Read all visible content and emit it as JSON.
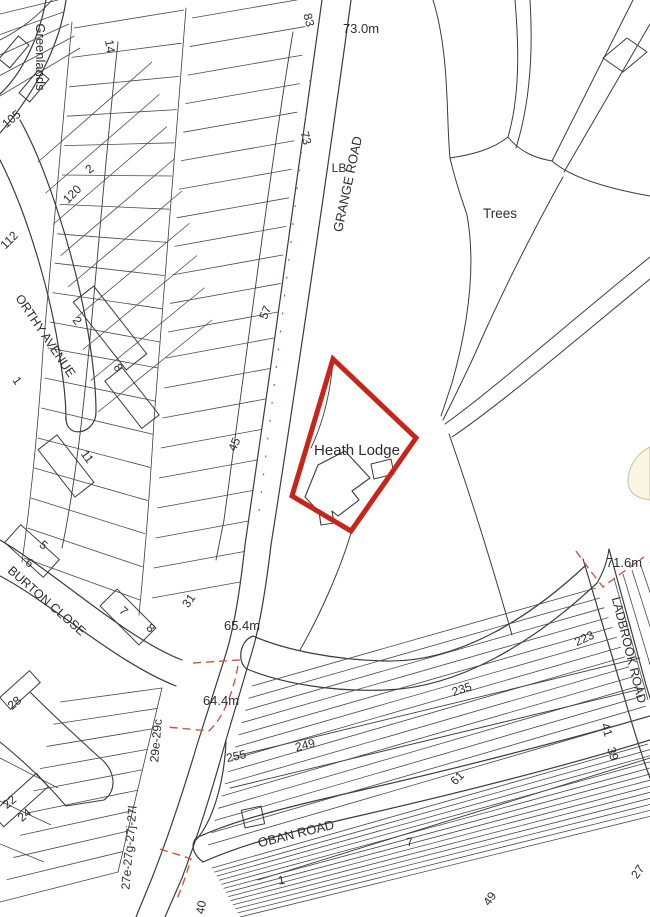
{
  "map": {
    "title": "Ordnance-survey style location plan, Heath Lodge, Grange Road",
    "colors": {
      "background": "#ffffff",
      "linework": "#3c3c3c",
      "plot_line": "#4a4a4a",
      "site_red": "#c8251a",
      "dashed_red": "#cf5742",
      "tan_fill": "#faf6e3",
      "tan_stroke": "#c9c09b"
    },
    "site_boundary": {
      "points": "333,359 416,438 351,531 292,496",
      "stroke_width": 5
    },
    "labels": [
      {
        "t": "Greenlands",
        "x": 36,
        "y": 57,
        "r": 90,
        "s": 13
      },
      {
        "t": "14",
        "x": 106,
        "y": 47,
        "r": 81,
        "s": 12
      },
      {
        "t": "105",
        "x": 14,
        "y": 122,
        "r": -40,
        "s": 12
      },
      {
        "t": "2",
        "x": 92,
        "y": 172,
        "r": -40,
        "s": 12
      },
      {
        "t": "120",
        "x": 75,
        "y": 197,
        "r": -45,
        "s": 12
      },
      {
        "t": "112",
        "x": 12,
        "y": 243,
        "r": -45,
        "s": 12
      },
      {
        "t": "83",
        "x": 305,
        "y": 21,
        "r": 75,
        "s": 12
      },
      {
        "t": "73",
        "x": 302,
        "y": 139,
        "r": 75,
        "s": 12
      },
      {
        "t": "73.0m",
        "x": 361,
        "y": 33,
        "r": 0,
        "s": 13
      },
      {
        "t": "GRANGE ROAD",
        "x": 352,
        "y": 185,
        "r": -78,
        "s": 13
      },
      {
        "t": "LB",
        "x": 339,
        "y": 172,
        "r": 0,
        "s": 12
      },
      {
        "t": "Trees",
        "x": 500,
        "y": 218,
        "r": 0,
        "s": 13.5
      },
      {
        "t": "ORTHY AVENUE",
        "x": 42,
        "y": 338,
        "r": 56,
        "s": 12.5
      },
      {
        "t": "2",
        "x": 74,
        "y": 323,
        "r": 54,
        "s": 12
      },
      {
        "t": "8",
        "x": 115,
        "y": 370,
        "r": 54,
        "s": 12
      },
      {
        "t": "1",
        "x": 14,
        "y": 383,
        "r": 54,
        "s": 12
      },
      {
        "t": "11",
        "x": 84,
        "y": 459,
        "r": 54,
        "s": 12
      },
      {
        "t": "5",
        "x": 41,
        "y": 548,
        "r": 40,
        "s": 12
      },
      {
        "t": "6",
        "x": 27,
        "y": 566,
        "r": 40,
        "s": 12
      },
      {
        "t": "BURTON CLOSE",
        "x": 44,
        "y": 604,
        "r": 41,
        "s": 12.5
      },
      {
        "t": "7",
        "x": 121,
        "y": 614,
        "r": 42,
        "s": 12
      },
      {
        "t": "8",
        "x": 148,
        "y": 631,
        "r": 42,
        "s": 12
      },
      {
        "t": "28",
        "x": 17,
        "y": 706,
        "r": -40,
        "s": 12
      },
      {
        "t": "31",
        "x": 192,
        "y": 603,
        "r": -55,
        "s": 12
      },
      {
        "t": "45",
        "x": 238,
        "y": 446,
        "r": -67,
        "s": 12
      },
      {
        "t": "57",
        "x": 269,
        "y": 314,
        "r": -67,
        "s": 12
      },
      {
        "t": "Heath Lodge",
        "x": 357,
        "y": 455,
        "r": 0,
        "s": 15
      },
      {
        "t": "65.4m",
        "x": 242,
        "y": 630,
        "r": 0,
        "s": 13
      },
      {
        "t": "64.4m",
        "x": 221,
        "y": 705,
        "r": 0,
        "s": 13
      },
      {
        "t": "29e-29c",
        "x": 160,
        "y": 741,
        "r": -85,
        "s": 12
      },
      {
        "t": "27e-27g-27j-27l",
        "x": 133,
        "y": 848,
        "r": -85,
        "s": 12
      },
      {
        "t": "22",
        "x": 12,
        "y": 805,
        "r": -40,
        "s": 12
      },
      {
        "t": "24",
        "x": 27,
        "y": 818,
        "r": -40,
        "s": 12
      },
      {
        "t": "40",
        "x": 205,
        "y": 908,
        "r": -80,
        "s": 12
      },
      {
        "t": "71.6m",
        "x": 624,
        "y": 567,
        "r": 0,
        "s": 13
      },
      {
        "t": "LADBROOK ROAD",
        "x": 625,
        "y": 651,
        "r": 76,
        "s": 12.5
      },
      {
        "t": "223",
        "x": 586,
        "y": 642,
        "r": -25,
        "s": 12
      },
      {
        "t": "235",
        "x": 463,
        "y": 693,
        "r": -18,
        "s": 12
      },
      {
        "t": "249",
        "x": 306,
        "y": 749,
        "r": -14,
        "s": 12
      },
      {
        "t": "255",
        "x": 237,
        "y": 760,
        "r": -12,
        "s": 12
      },
      {
        "t": "OBAN ROAD",
        "x": 297,
        "y": 838,
        "r": -14,
        "s": 13
      },
      {
        "t": "1",
        "x": 282,
        "y": 884,
        "r": -10,
        "s": 12
      },
      {
        "t": "7",
        "x": 410,
        "y": 846,
        "r": -5,
        "s": 12
      },
      {
        "t": "41",
        "x": 603,
        "y": 731,
        "r": 72,
        "s": 12
      },
      {
        "t": "39",
        "x": 609,
        "y": 755,
        "r": 72,
        "s": 12
      },
      {
        "t": "61",
        "x": 460,
        "y": 781,
        "r": -45,
        "s": 12
      },
      {
        "t": "49",
        "x": 493,
        "y": 901,
        "r": -55,
        "s": 12
      },
      {
        "t": "27",
        "x": 641,
        "y": 874,
        "r": -55,
        "s": 12
      }
    ],
    "roads_and_boundaries": [
      {
        "d": "M322,0 C303,140 272,360 245,545 C240,590 234,630 224,660 L197,745 C186,782 170,832 152,878 L136,917",
        "w": 1.2
      },
      {
        "d": "M351,0 C332,140 300,360 271,545 C266,588 261,618 254,645 L226,740 C215,780 200,830 182,878 L165,917",
        "w": 1.2
      },
      {
        "d": "M186,8 C175,150 163,300 154,420 C150,490 145,555 139,615",
        "w": 0.8
      },
      {
        "d": "M72,22 C62,130 52,250 43,350 C38,430 30,505 22,562",
        "w": 0.8
      },
      {
        "d": "M46,0 C39,38 22,74 0,94",
        "w": 1.2
      },
      {
        "d": "M66,0 C60,44 36,92 0,133",
        "w": 1.2
      },
      {
        "d": "M20,120 C48,170 76,262 88,332 C93,362 96,392 96,412",
        "w": 1.2
      },
      {
        "d": "M0,160 C28,215 52,298 60,358 C64,385 66,400 66,420",
        "w": 1.2
      },
      {
        "d": "M96,412 C96,434 66,440 66,418",
        "w": 1.2
      },
      {
        "d": "M0,540 C55,572 125,638 182,660",
        "w": 1.2
      },
      {
        "d": "M0,576 C50,602 115,662 176,686",
        "w": 1.2
      },
      {
        "d": "M253,636 C285,650 335,660 385,661 C455,663 525,622 585,566",
        "w": 1.2
      },
      {
        "d": "M247,669 C283,684 335,692 385,690 C458,688 532,644 597,583",
        "w": 1.2
      },
      {
        "d": "M253,636 C239,641 237,663 247,669",
        "w": 1.2
      },
      {
        "d": "M583,559 C595,598 612,655 628,710 C636,737 644,762 650,778",
        "w": 1.2
      },
      {
        "d": "M609,549 C620,590 634,640 646,685 L650,698",
        "w": 1.2
      },
      {
        "d": "M196,838 C240,818 300,804 362,790 C450,770 560,742 650,716",
        "w": 1.2
      },
      {
        "d": "M203,862 C248,842 305,828 367,814 C458,793 565,766 650,740",
        "w": 1.2
      },
      {
        "d": "M226,742 C224,785 212,822 196,840",
        "w": 1.2
      },
      {
        "d": "M196,838 C189,847 196,857 203,862",
        "w": 1.2
      },
      {
        "d": "M597,583 C603,573 607,563 609,549",
        "w": 1.1
      },
      {
        "d": "M633,0 L552,161",
        "w": 1
      },
      {
        "d": "M650,24 L564,172",
        "w": 1
      },
      {
        "d": "M552,161 C570,177 605,188 650,196",
        "w": 1
      },
      {
        "d": "M433,0 C450,55 446,118 450,158 C457,188 463,202 467,215 C476,265 469,322 452,383 L441,416",
        "w": 1
      },
      {
        "d": "M515,0 C519,48 520,95 508,137",
        "w": 1
      },
      {
        "d": "M530,0 C533,48 531,100 516,148",
        "w": 1
      },
      {
        "d": "M508,137 C520,152 535,158 552,161",
        "w": 1
      },
      {
        "d": "M450,158 C470,155 492,150 508,137",
        "w": 1
      },
      {
        "d": "M563,177 C540,218 508,280 482,338 C470,366 455,396 443,420",
        "w": 1
      },
      {
        "d": "M650,257 C560,330 490,392 445,424",
        "w": 1
      },
      {
        "d": "M650,279 C570,345 498,406 452,437",
        "w": 1
      },
      {
        "d": "M449,434 C472,500 495,575 512,635",
        "w": 1
      },
      {
        "d": "M351,533 C340,570 320,615 300,650",
        "w": 1
      },
      {
        "d": "M333,362 C330,395 322,425 311,448",
        "w": 0.9
      },
      {
        "d": "M603,58 L627,38 L647,52 L623,72 Z",
        "w": 1
      },
      {
        "d": "M305,497 L318,465 L345,451 L370,478 L352,491 L359,500 L338,516 L332,511 L334,523 L321,525 L319,512 Z",
        "w": 1.1
      },
      {
        "d": "M371,464 L391,459 L394,474 L374,479 Z",
        "w": 1
      },
      {
        "d": "M293,32 C273,150 247,350 224,520 L216,560",
        "w": 0.9
      },
      {
        "d": "M118,42 C106,150 96,280 86,380 C80,440 72,500 62,548",
        "w": 0.9
      },
      {
        "d": "M236,756 L640,658",
        "w": 0.9
      },
      {
        "d": "M230,788 L645,688",
        "w": 0.9
      },
      {
        "d": "M258,880 L650,758",
        "w": 0.9
      },
      {
        "d": "M30,692 C50,712 78,738 100,758",
        "w": 1.1
      },
      {
        "d": "M0,742 C25,762 48,785 66,806",
        "w": 1.1
      },
      {
        "d": "M100,758 C115,770 118,790 104,800 L66,806",
        "w": 1.1
      },
      {
        "d": "M162,688 C150,740 135,800 118,872",
        "w": 0.8
      },
      {
        "d": "M0,40 C20,30 38,16 52,0",
        "w": 0.9
      }
    ],
    "plot_line_fans": [
      {
        "a": [
          192,
          18
        ],
        "c": [
          168,
          332
        ],
        "b": [
          308,
          -2
        ],
        "d": [
          278,
          312
        ],
        "n": 12
      },
      {
        "a": [
          166,
          358
        ],
        "c": [
          152,
          598
        ],
        "b": [
          274,
          338
        ],
        "d": [
          240,
          582
        ],
        "n": 9
      },
      {
        "a": [
          74,
          28
        ],
        "c": [
          50,
          322
        ],
        "b": [
          184,
          10
        ],
        "d": [
          160,
          342
        ],
        "n": 11
      },
      {
        "a": [
          48,
          348
        ],
        "c": [
          24,
          558
        ],
        "b": [
          158,
          368
        ],
        "d": [
          140,
          600
        ],
        "n": 8
      },
      {
        "a": [
          38,
          162
        ],
        "c": [
          98,
          412
        ],
        "b": [
          152,
          62
        ],
        "d": [
          212,
          320
        ],
        "n": 9
      },
      {
        "a": [
          252,
          686
        ],
        "c": [
          208,
          845
        ],
        "b": [
          596,
          588
        ],
        "d": [
          650,
          716
        ],
        "n": 14
      },
      {
        "a": [
          212,
          868
        ],
        "c": [
          240,
          917
        ],
        "b": [
          648,
          744
        ],
        "d": [
          676,
          810
        ],
        "n": 13
      },
      {
        "a": [
          614,
          578
        ],
        "c": [
          650,
          562
        ],
        "b": [
          648,
          700
        ],
        "d": [
          690,
          672
        ],
        "n": 5
      },
      {
        "a": [
          60,
          702
        ],
        "c": [
          0,
          902
        ],
        "b": [
          162,
          688
        ],
        "d": [
          118,
          872
        ],
        "n": 10
      },
      {
        "a": [
          0,
          14
        ],
        "c": [
          0,
          96
        ],
        "b": [
          58,
          0
        ],
        "d": [
          80,
          48
        ],
        "n": 5
      },
      {
        "a": [
          0,
          758
        ],
        "c": [
          0,
          844
        ],
        "b": [
          58,
          788
        ],
        "d": [
          44,
          862
        ],
        "n": 3
      }
    ],
    "building_rects": [
      {
        "cx": 110,
        "cy": 328,
        "w": 86,
        "h": 26,
        "r": 52
      },
      {
        "cx": 132,
        "cy": 398,
        "w": 60,
        "h": 22,
        "r": 52
      },
      {
        "cx": 66,
        "cy": 466,
        "w": 60,
        "h": 24,
        "r": 52
      },
      {
        "cx": 32,
        "cy": 551,
        "w": 52,
        "h": 24,
        "r": 42
      },
      {
        "cx": 128,
        "cy": 617,
        "w": 55,
        "h": 24,
        "r": 45
      },
      {
        "cx": 20,
        "cy": 690,
        "w": 40,
        "h": 16,
        "r": -42
      },
      {
        "cx": 20,
        "cy": 800,
        "w": 60,
        "h": 18,
        "r": -42
      },
      {
        "cx": 253,
        "cy": 817,
        "w": 20,
        "h": 18,
        "r": -12
      },
      {
        "cx": 14,
        "cy": 52,
        "w": 30,
        "h": 14,
        "r": -50
      },
      {
        "cx": 34,
        "cy": 86,
        "w": 30,
        "h": 14,
        "r": -50
      }
    ],
    "red_dashed_paths": [
      {
        "d": "M193,663 L239,660 C233,696 222,719 209,731 L167,727",
        "w": 1.4,
        "dash": "8,5"
      },
      {
        "d": "M160,849 C172,853 183,856 191,859 C186,876 181,890 176,901",
        "w": 1.4,
        "dash": "8,5"
      },
      {
        "d": "M576,551 C586,565 595,577 603,587 C616,577 630,567 644,557",
        "w": 1.4,
        "dash": "8,5"
      },
      {
        "d": "M310,80 C292,230 274,390 258,520",
        "w": 1.2,
        "dash": "2,16"
      }
    ],
    "tan_area": {
      "d": "M650,447 C640,452 630,462 628,478 C627,490 633,498 650,500 Z"
    }
  }
}
